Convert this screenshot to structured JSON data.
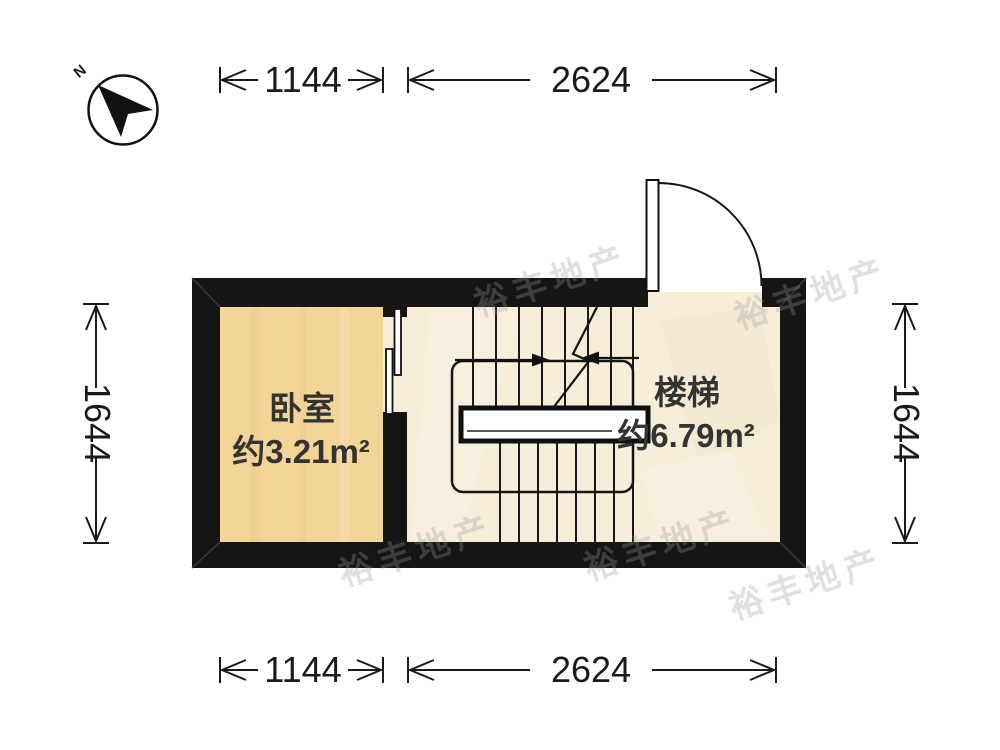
{
  "compass": {
    "label": "N"
  },
  "dimensions": {
    "top": [
      "1144",
      "2624"
    ],
    "bottom": [
      "1144",
      "2624"
    ],
    "left": "1644",
    "right": "1644"
  },
  "rooms": {
    "bedroom": {
      "name": "卧室",
      "area": "约3.21m²"
    },
    "stairs": {
      "name": "楼梯",
      "area": "约6.79m²"
    }
  },
  "colors": {
    "wall": "#151515",
    "bedroom_floor": "#f3d697",
    "stair_floor": "#f6eed9",
    "landing_fill": "#ffffff"
  },
  "watermark": {
    "text": "裕丰地产"
  }
}
